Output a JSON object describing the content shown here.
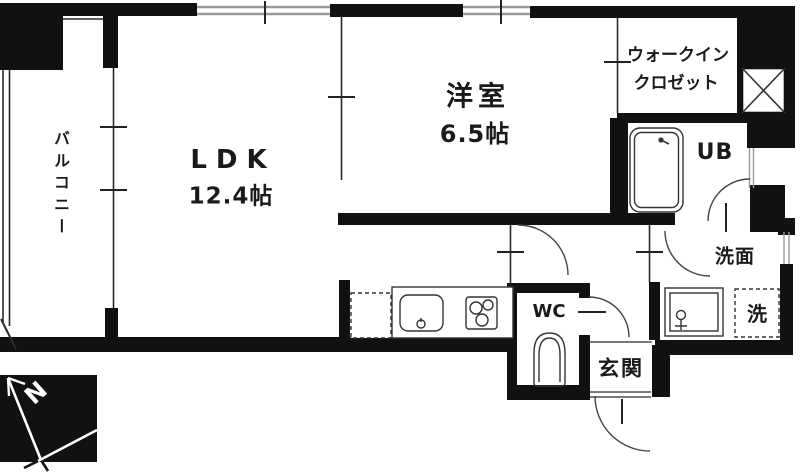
{
  "floorplan": {
    "rooms": {
      "ldk": {
        "name": "LDK",
        "size": "12.4帖"
      },
      "western_room": {
        "name": "洋室",
        "size": "6.5帖"
      },
      "walk_in_closet": {
        "name_line1": "ウォークイン",
        "name_line2": "クロゼット"
      },
      "balcony": {
        "name": "バルコニー"
      },
      "unit_bath": {
        "name": "UB"
      },
      "toilet": {
        "name": "WC"
      },
      "entrance": {
        "name": "玄関"
      },
      "washroom": {
        "name": "洗面"
      },
      "washer_space": {
        "name": "洗"
      }
    },
    "compass": {
      "north_label": "N"
    },
    "colors": {
      "wall": "#111111",
      "thin_line": "#2a2a2a",
      "window_line": "#999999",
      "background": "#ffffff",
      "text": "#1a1a1a"
    }
  }
}
